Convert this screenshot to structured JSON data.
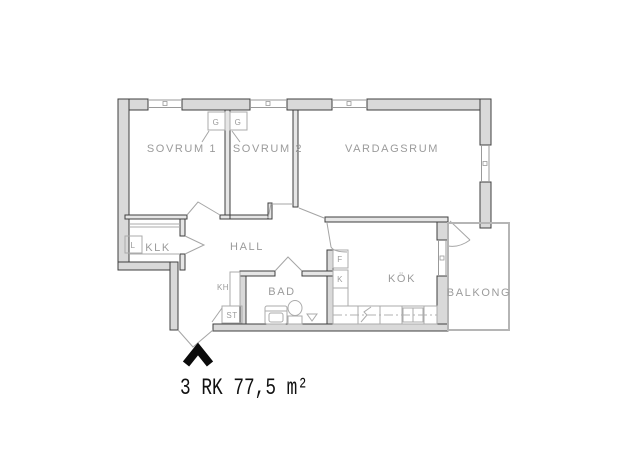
{
  "plan": {
    "caption": "3 RK 77,5 m²"
  },
  "rooms": {
    "sovrum1": "SOVRUM 1",
    "sovrum2": "SOVRUM 2",
    "vardagsrum": "VARDAGSRUM",
    "klk": "KLK",
    "hall": "HALL",
    "bad": "BAD",
    "kok": "KÖK",
    "balkong": "BALKONG"
  },
  "fixtures": {
    "wardrobe_left": "G",
    "wardrobe_right": "G",
    "linen_cabinet": "L",
    "freezer": "F",
    "fridge": "K",
    "coat_rack": "KH",
    "cleaning_cabinet": "ST"
  },
  "colors": {
    "background": "#ffffff",
    "wall_fill": "#d9d9d9",
    "wall_stroke": "#3f3f3f",
    "interior_wall_fill": "#e6e6e6",
    "window_line": "#9a9a9a",
    "fixture_line": "#ababab",
    "label_text": "#9b9b9b",
    "balcony_line": "#b5b5b5",
    "caption_text": "#111111",
    "entrance_marker": "#0b0b0b"
  }
}
